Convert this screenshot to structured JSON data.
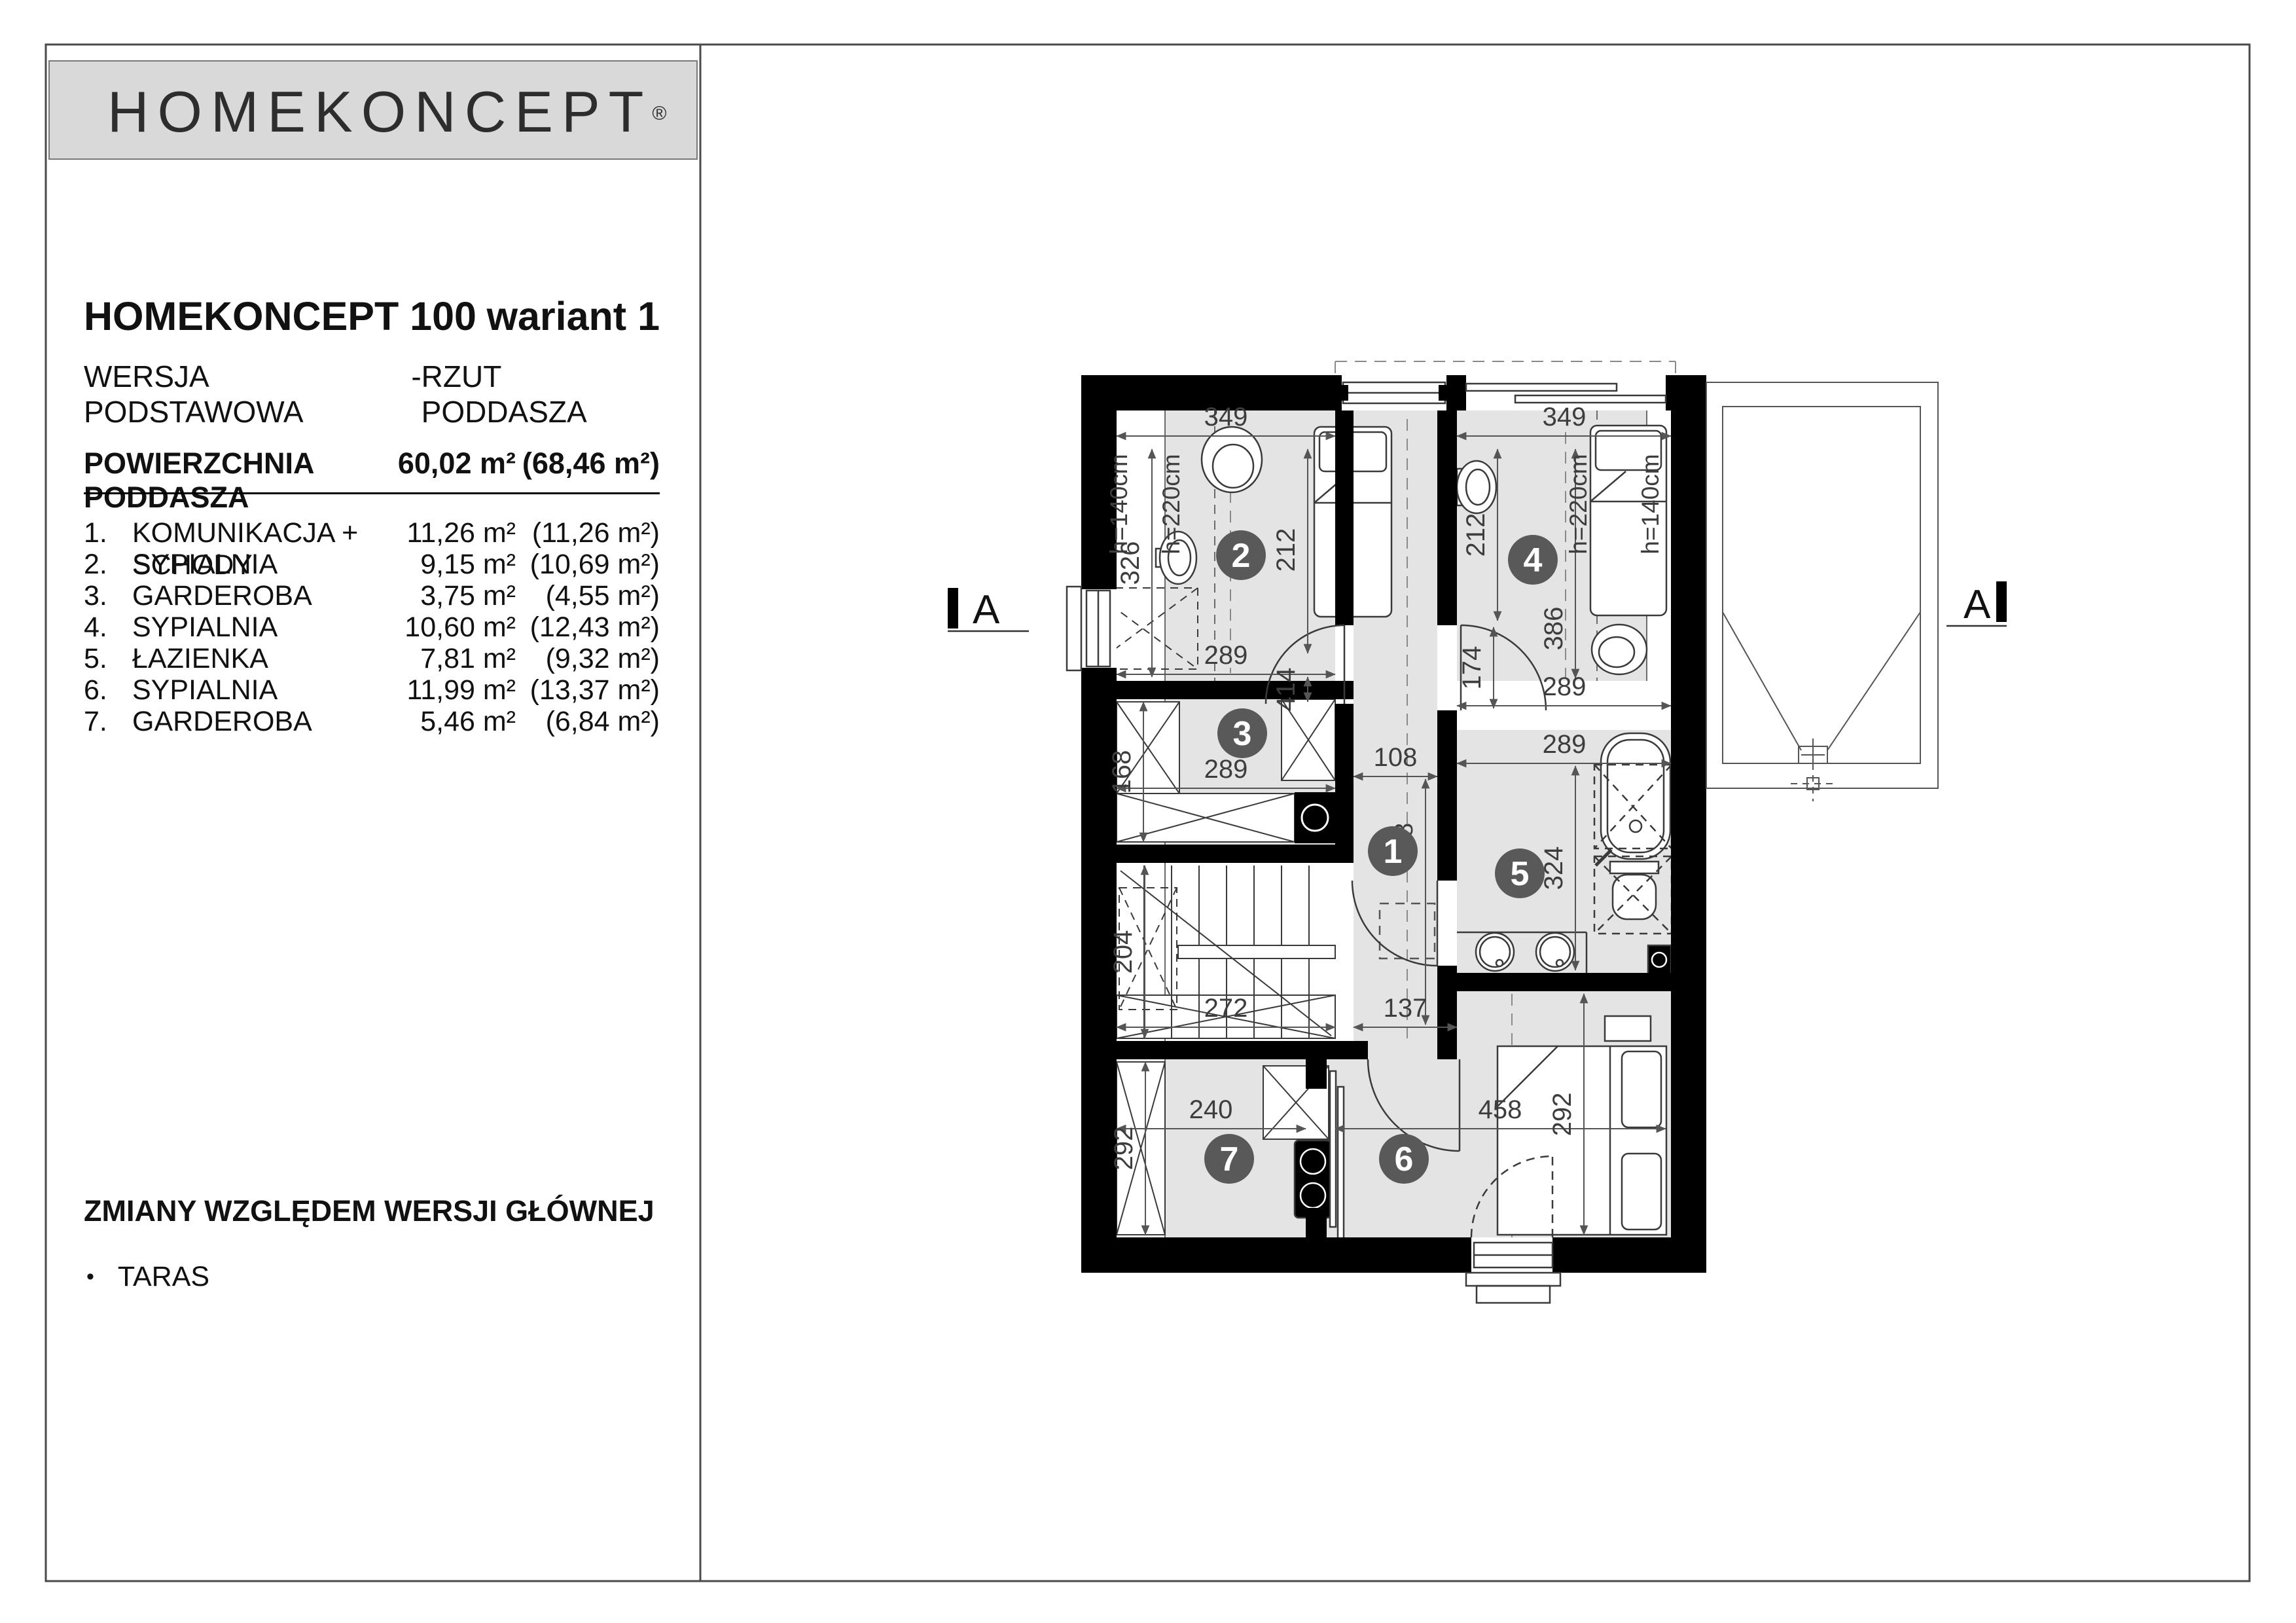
{
  "logo": {
    "text": "HOMEKONCEPT",
    "reg": "®"
  },
  "header": {
    "title": "HOMEKONCEPT 100",
    "variant": "wariant 1",
    "version": "WERSJA PODSTAWOWA",
    "sep": "-",
    "view": "RZUT PODDASZA"
  },
  "area_table": {
    "header": {
      "label": "POWIERZCHNIA PODDASZA",
      "area": "60,02 m²",
      "area_total": "(68,46 m²)"
    },
    "rows": [
      {
        "no": "1.",
        "label": "KOMUNIKACJA + SCHODY",
        "area": "11,26 m²",
        "area_total": "(11,26 m²)"
      },
      {
        "no": "2.",
        "label": "SYPIALNIA",
        "area": "9,15 m²",
        "area_total": "(10,69 m²)"
      },
      {
        "no": "3.",
        "label": "GARDEROBA",
        "area": "3,75 m²",
        "area_total": "(4,55 m²)"
      },
      {
        "no": "4.",
        "label": "SYPIALNIA",
        "area": "10,60 m²",
        "area_total": "(12,43 m²)"
      },
      {
        "no": "5.",
        "label": "ŁAZIENKA",
        "area": "7,81 m²",
        "area_total": "(9,32 m²)"
      },
      {
        "no": "6.",
        "label": "SYPIALNIA",
        "area": "11,99 m²",
        "area_total": "(13,37 m²)"
      },
      {
        "no": "7.",
        "label": "GARDEROBA",
        "area": "5,46 m²",
        "area_total": "(6,84 m²)"
      }
    ]
  },
  "changes": {
    "heading": "ZMIANY WZGLĘDEM WERSJI GŁÓWNEJ",
    "bullet": "•",
    "items": [
      "TARAS"
    ]
  },
  "plan": {
    "rooms": {
      "r1": "1",
      "r2": "2",
      "r3": "3",
      "r4": "4",
      "r5": "5",
      "r6": "6",
      "r7": "7"
    },
    "dims": {
      "r2_w": "349",
      "r2_h": "212",
      "r2_nook": "326",
      "r2_b": "289",
      "r2_door": "414",
      "r4_w": "349",
      "r4_h": "212",
      "r4_len": "386",
      "r4_door": "174",
      "r4_strip": "289",
      "r3_w": "289",
      "r3_h": "168",
      "st_w": "272",
      "st_h": "204",
      "c_w": "108",
      "c_len": "498",
      "c_w2": "137",
      "r5_w": "289",
      "r5_h": "324",
      "r7_w": "240",
      "r7_h": "292",
      "r6_w": "458",
      "r6_h": "292"
    },
    "heights": {
      "l140": "h=140cm",
      "l220": "h=220cm",
      "r220": "h=220cm",
      "r140": "h=140cm"
    },
    "section": {
      "label": "A"
    },
    "colors": {
      "wall": "#000000",
      "floor": "#e4e4e4",
      "room_badge": "#595959",
      "line": "#3a3a3a"
    }
  }
}
